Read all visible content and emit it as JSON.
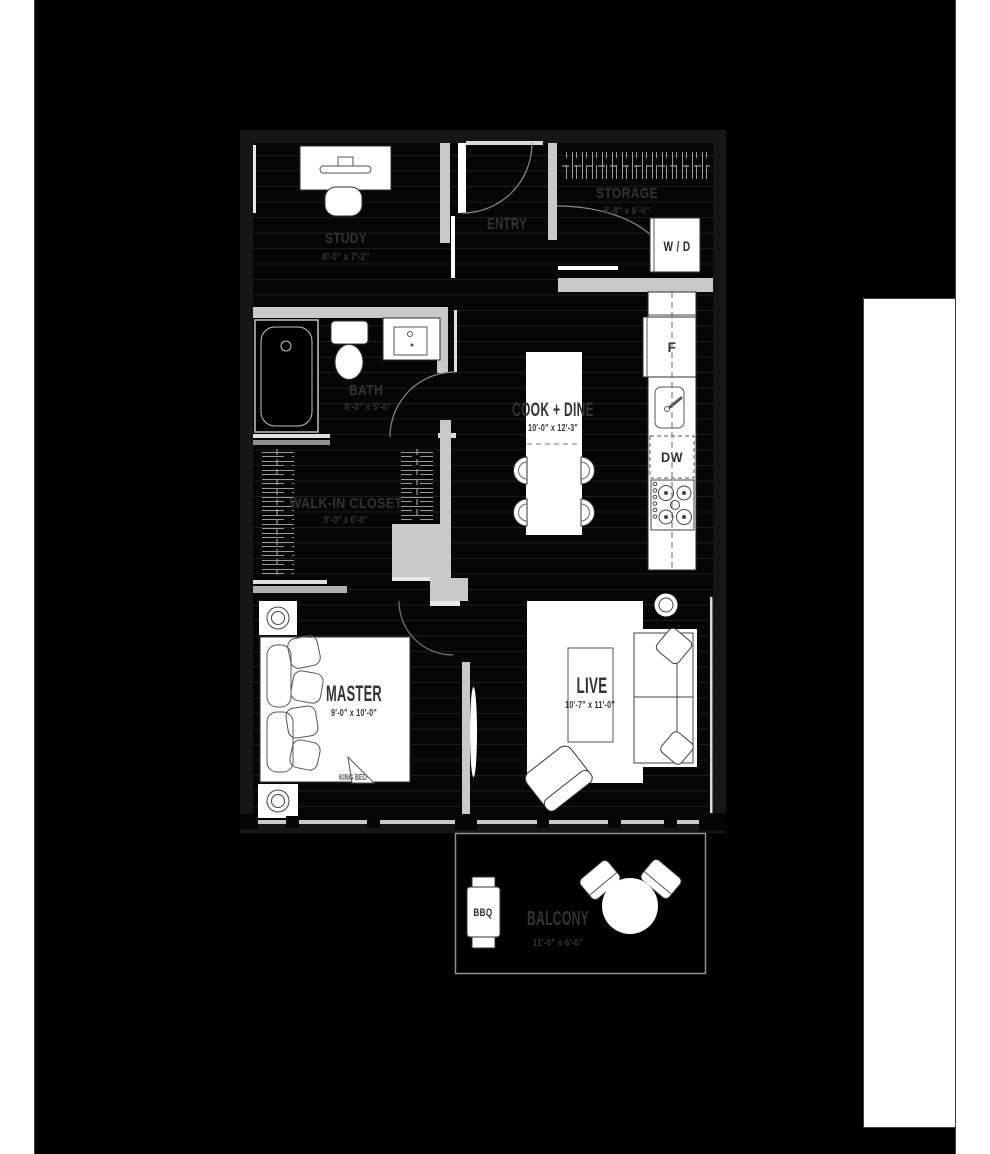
{
  "floorplan": {
    "rooms": {
      "study": {
        "label": "STUDY",
        "dims": "8'-0\" x 7'-2\""
      },
      "entry": {
        "label": "ENTRY"
      },
      "storage": {
        "label": "STORAGE",
        "dims": "6'-8\" x 6'-0\""
      },
      "bath": {
        "label": "BATH",
        "dims": "8'-0\" x 5'-8\""
      },
      "cook_dine": {
        "label": "COOK + DINE",
        "dims": "10'-0\" x 12'-3\""
      },
      "closet": {
        "label": "WALK-IN CLOSET",
        "dims": "8'-0\" x 6'-0\""
      },
      "master": {
        "label": "MASTER",
        "dims": "9'-0\" x 10'-0\"",
        "bed_label": "KING BED"
      },
      "live": {
        "label": "LIVE",
        "dims": "10'-7\" x 11'-0\""
      },
      "balcony": {
        "label": "BALCONY",
        "dims": "11'-0\" x 6'-6\""
      }
    },
    "appliances": {
      "washer_dryer": "W / D",
      "fridge": "F",
      "dishwasher": "DW",
      "bbq": "BBQ"
    },
    "colors": {
      "background": "#000000",
      "page_margin": "#ffffff",
      "interior_wall": "#c9c9c9",
      "exterior_wall": "#161616",
      "fixture_fill": "#ffffff",
      "label_text": "#333333",
      "plank_line": "#1c1c1c"
    }
  }
}
